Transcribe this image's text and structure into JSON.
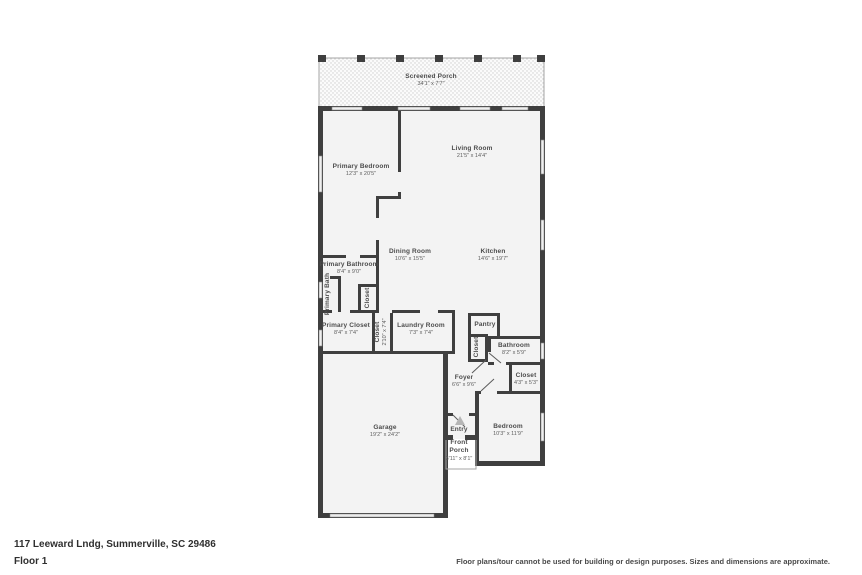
{
  "footer": {
    "address": "117 Leeward Lndg, Summerville, SC 29486",
    "floor_label": "Floor 1",
    "disclaimer": "Floor plans/tour cannot be used for building or design purposes. Sizes and dimensions are approximate."
  },
  "colors": {
    "wall": "#3f3f3f",
    "room_fill": "#f3f3f3",
    "porch_dot": "#cfcfcf",
    "label_text": "#4c4c4c"
  },
  "rooms": {
    "screened_porch": {
      "name": "Screened Porch",
      "dims": "34'1\" x 7'7\""
    },
    "living_room": {
      "name": "Living Room",
      "dims": "21'5\" x 14'4\""
    },
    "primary_bedroom": {
      "name": "Primary Bedroom",
      "dims": "12'3\" x 20'5\""
    },
    "dining_room": {
      "name": "Dining Room",
      "dims": "10'6\" x 15'5\""
    },
    "kitchen": {
      "name": "Kitchen",
      "dims": "14'6\" x 19'7\""
    },
    "primary_bathroom": {
      "name": "Primary Bathroom",
      "dims": "8'4\" x 9'0\""
    },
    "primary_bath": {
      "name": "Primary Bath"
    },
    "bath_closet": {
      "name": "Closet"
    },
    "primary_closet": {
      "name": "Primary Closet",
      "dims": "8'4\" x 7'4\""
    },
    "closet_strip": {
      "name": "Closet",
      "dims": "2'10\" x 7'4\""
    },
    "laundry_room": {
      "name": "Laundry Room",
      "dims": "7'3\" x 7'4\""
    },
    "pantry": {
      "name": "Pantry"
    },
    "pantry_closet": {
      "name": "Closet"
    },
    "bathroom": {
      "name": "Bathroom",
      "dims": "8'2\" x 5'9\""
    },
    "foyer": {
      "name": "Foyer",
      "dims": "6'6\" x 9'6\""
    },
    "hall_closet": {
      "name": "Closet",
      "dims": "4'3\" x 5'3\""
    },
    "bedroom": {
      "name": "Bedroom",
      "dims": "10'3\" x 11'9\""
    },
    "garage": {
      "name": "Garage",
      "dims": "19'2\" x 24'2\""
    },
    "entry": {
      "name": "Entry"
    },
    "front_porch": {
      "name": "Front Porch",
      "dims": "3'11\" x 8'1\""
    }
  }
}
